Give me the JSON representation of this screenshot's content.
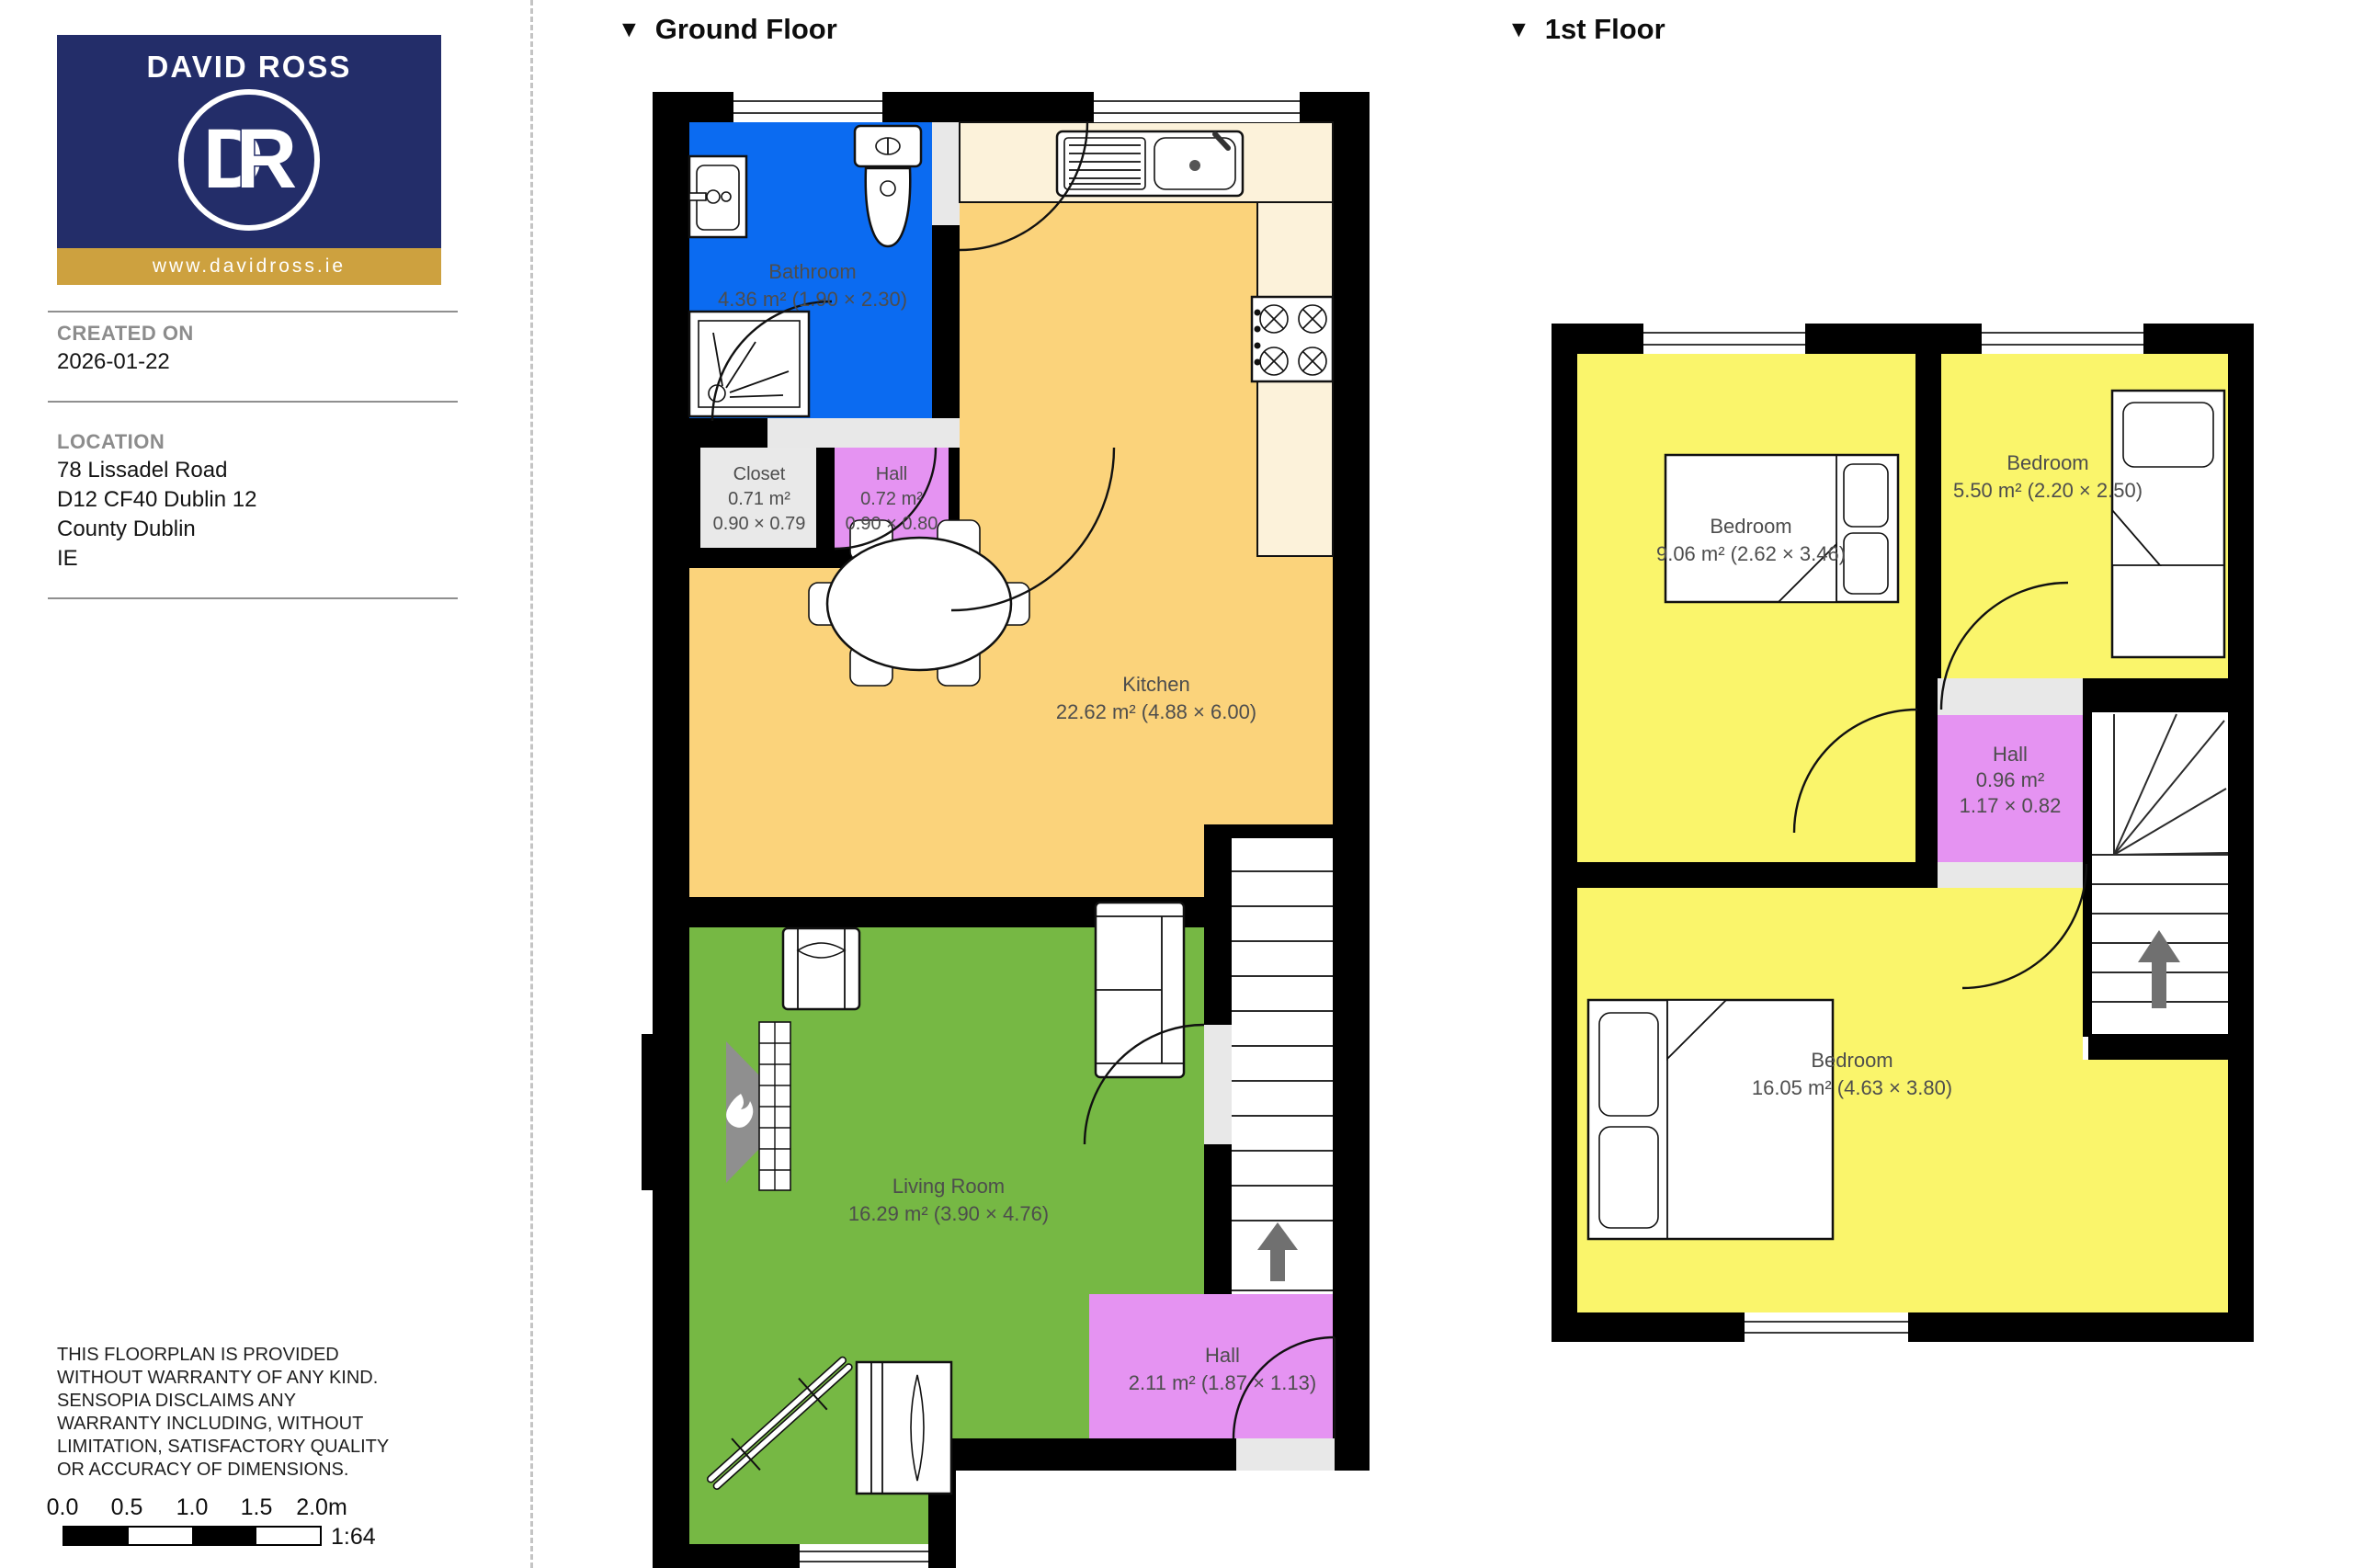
{
  "sidebar": {
    "logo": {
      "agency": "DAVID ROSS",
      "monogram_d": "D",
      "monogram_r": "R",
      "website": "www.davidross.ie"
    },
    "created": {
      "label": "CREATED ON",
      "value": "2026-01-22"
    },
    "location": {
      "label": "LOCATION",
      "line1": "78 Lissadel Road",
      "line2": "D12 CF40 Dublin 12",
      "line3": "County Dublin",
      "line4": "IE"
    },
    "disclaimer": "THIS FLOORPLAN IS PROVIDED WITHOUT WARRANTY OF ANY KIND. SENSOPIA DISCLAIMS ANY WARRANTY INCLUDING, WITHOUT LIMITATION, SATISFACTORY QUALITY OR ACCURACY OF DIMENSIONS.",
    "scale": {
      "t0": "0.0",
      "t1": "0.5",
      "t2": "1.0",
      "t3": "1.5",
      "t4": "2.0m",
      "ratio": "1:64"
    }
  },
  "floors": {
    "ground": {
      "marker": "▼",
      "title": "Ground Floor"
    },
    "first": {
      "marker": "▼",
      "title": "1st Floor"
    }
  },
  "ground_rooms": {
    "bathroom": {
      "name": "Bathroom",
      "detail": "4.36 m² (1.90 × 2.30)"
    },
    "closet": {
      "name": "Closet",
      "area": "0.71 m²",
      "dims": "0.90 × 0.79"
    },
    "hall_small": {
      "name": "Hall",
      "area": "0.72 m²",
      "dims": "0.90 × 0.80"
    },
    "kitchen": {
      "name": "Kitchen",
      "detail": "22.62 m² (4.88 × 6.00)"
    },
    "living": {
      "name": "Living Room",
      "detail": "16.29 m² (3.90 × 4.76)"
    },
    "hall": {
      "name": "Hall",
      "detail": "2.11 m² (1.87 × 1.13)"
    }
  },
  "first_rooms": {
    "bedroom1": {
      "name": "Bedroom",
      "detail": "9.06 m² (2.62 × 3.46)"
    },
    "bedroom2": {
      "name": "Bedroom",
      "detail": "5.50 m² (2.20 × 2.50)"
    },
    "hall": {
      "name": "Hall",
      "area": "0.96 m²",
      "dims": "1.17 × 0.82"
    },
    "bedroom3": {
      "name": "Bedroom",
      "detail": "16.05 m² (4.63 × 3.80)"
    }
  },
  "colors": {
    "navy": "#232d69",
    "gold": "#cda13f",
    "bathroom_blue": "#0b6bf1",
    "kitchen_orange": "#fbd37b",
    "counter_cream": "#fcf2da",
    "living_green": "#76b844",
    "hall_purple": "#e593f2",
    "bedroom_yellow": "#faf56b",
    "closet_gray": "#e9e9e9",
    "threshold_gray": "#e8e8e8",
    "fireplace_gray": "#8f8f8f",
    "arrow_gray": "#707070"
  }
}
